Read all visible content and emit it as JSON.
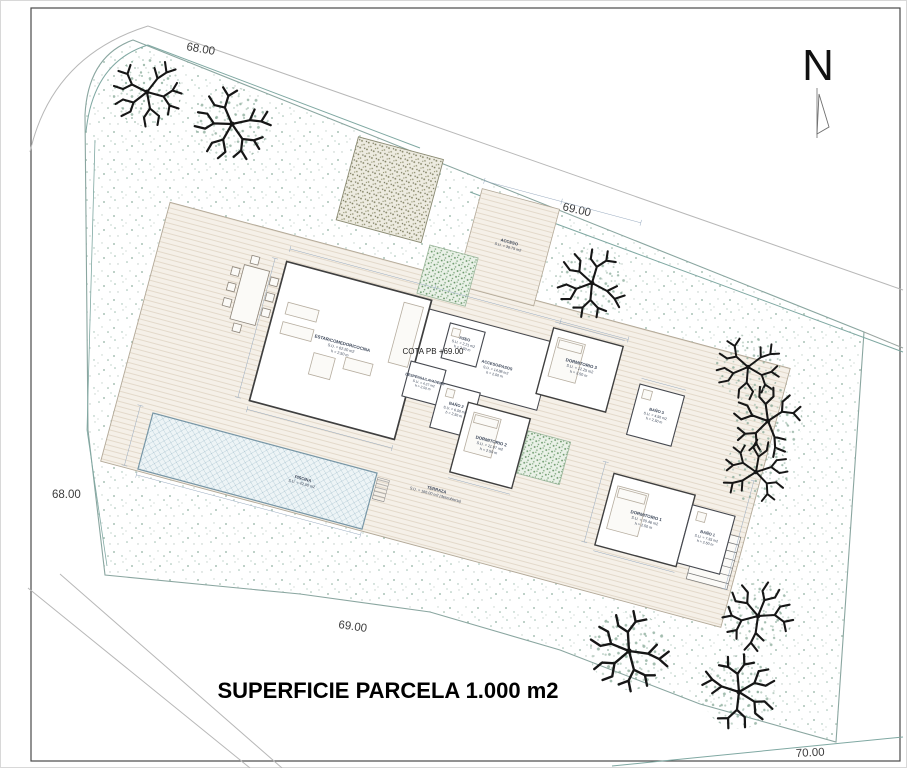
{
  "page": {
    "title": "SUPERFICIE PARCELA 1.000 m2",
    "north_label": "N"
  },
  "site": {
    "cota_label": "COTA PB +69.00",
    "elevation_labels": {
      "top": "68.00",
      "upper_right": "69.00",
      "left": "68.00",
      "bottom": "69.00",
      "bottom_right": "70.00"
    }
  },
  "rooms": [
    {
      "name": "ESTAR/COMEDOR/COCINA",
      "area": "S.U. = 62.20 m2",
      "height": "h = 2.50 m"
    },
    {
      "name": "ASEO",
      "area": "S.U. = 2.21 m2",
      "height": "h = 2.50 m"
    },
    {
      "name": "ACCESO/PASOS",
      "area": "S.U. = 14.88 m2",
      "height": "h = 2.50 m"
    },
    {
      "name": "DESPENSA/LAVADERO",
      "area": "S.U. = 4.27 m2",
      "height": "h = 2.50 m"
    },
    {
      "name": "BAÑO 2",
      "area": "S.U. = 6.50 m2",
      "height": "h = 2.50 m"
    },
    {
      "name": "DORMITORIO 2",
      "area": "S.U. = 11.97 m2",
      "height": "h = 2.50 m"
    },
    {
      "name": "DORMITORIO 3",
      "area": "S.U. = 12.25 m2",
      "height": "h = 2.50 m"
    },
    {
      "name": "BAÑO 3",
      "area": "S.U. = 4.50 m2",
      "height": "h = 2.50 m"
    },
    {
      "name": "DORMITORIO 1",
      "area": "S.U. = 20.46 m2",
      "height": "h = 2.50 m"
    },
    {
      "name": "BAÑO 1",
      "area": "S.U. = 7.35 m2",
      "height": "h = 2.50 m"
    }
  ],
  "outdoor": [
    {
      "name": "PISCINA",
      "area": "S.U. = 42.00 m2"
    },
    {
      "name": "TERRAZA",
      "area": "S.U. = 166.00 m2 (descubierta)"
    },
    {
      "name": "ACCESO",
      "area": "S.U. = 36.75 m2"
    }
  ],
  "colors": {
    "contour": "#7fa8a2",
    "boundary": "#8aa6a0",
    "tree": "#161616",
    "deck": "#f5f0e8",
    "pool": "#edf4f6",
    "stipple": "#9cbcae"
  }
}
